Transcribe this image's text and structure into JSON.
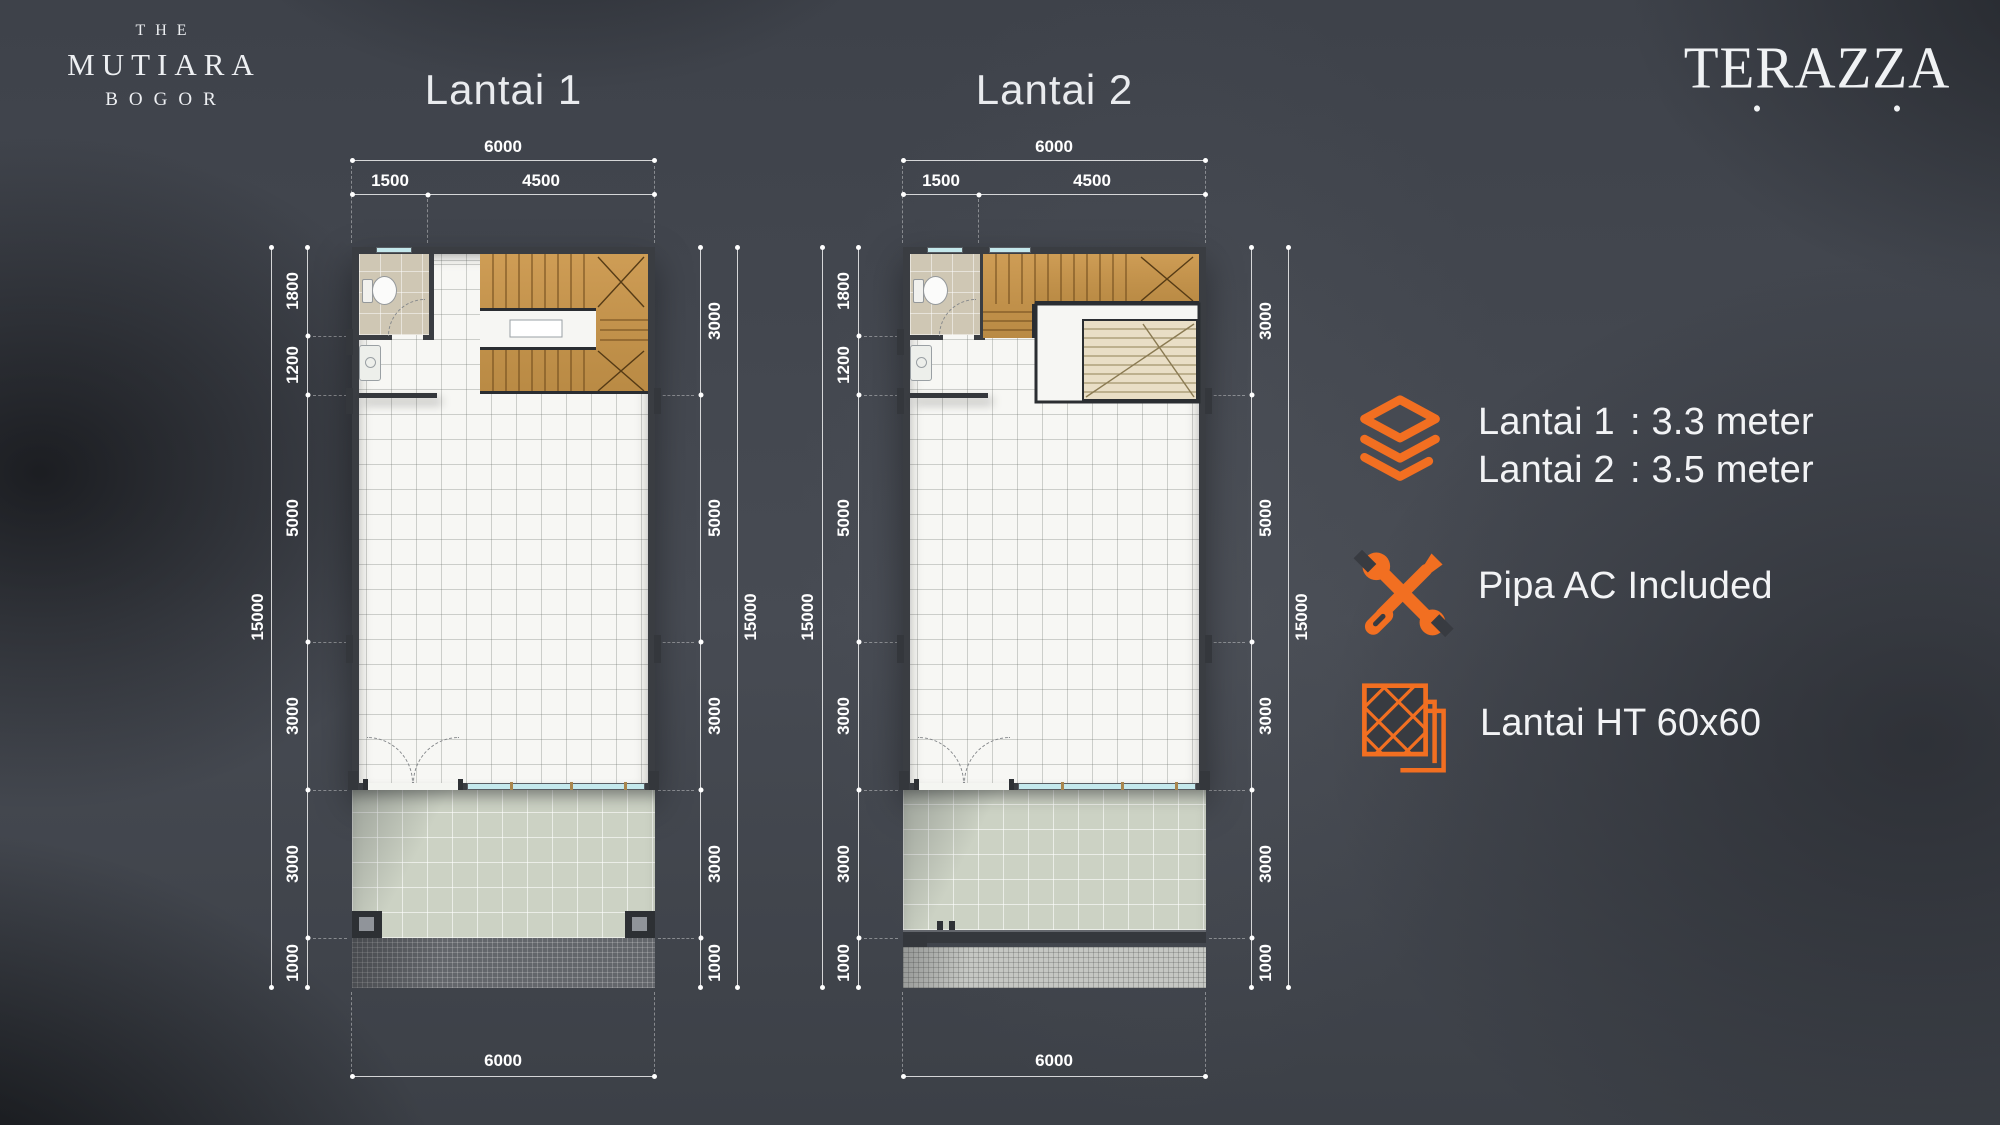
{
  "brand": {
    "line1": "THE",
    "line2": "MUTIARA",
    "line3": "BOGOR"
  },
  "product_logo": "TERAZZA",
  "colors": {
    "accent": "#F26F21",
    "wall": "#3a3d42",
    "wood": "#c5954f",
    "terrace": "#ccd2c4"
  },
  "plans": [
    {
      "title": "Lantai 1",
      "dims": {
        "top_total": "6000",
        "top_segments": [
          "1500",
          "4500"
        ],
        "left": [
          "1800",
          "1200",
          "5000",
          "3000",
          "3000",
          "1000"
        ],
        "left_total": "15000",
        "right": [
          "3000",
          "5000",
          "3000",
          "3000",
          "1000"
        ],
        "right_total": "15000",
        "bottom_total": "6000"
      }
    },
    {
      "title": "Lantai 2",
      "dims": {
        "top_total": "6000",
        "top_segments": [
          "1500",
          "4500"
        ],
        "left": [
          "1800",
          "1200",
          "5000",
          "3000",
          "3000",
          "1000"
        ],
        "left_total": "15000",
        "right": [
          "3000",
          "5000",
          "3000",
          "3000",
          "1000"
        ],
        "right_total": "15000",
        "bottom_total": "6000"
      }
    }
  ],
  "specs": {
    "heights": {
      "icon": "layers-icon",
      "rows": [
        {
          "label": "Lantai 1",
          "value": ": 3.3 meter"
        },
        {
          "label": "Lantai 2",
          "value": ": 3.5 meter"
        }
      ]
    },
    "ac": {
      "icon": "tools-icon",
      "text": "Pipa AC Included"
    },
    "floor": {
      "icon": "tile-icon",
      "text": "Lantai HT 60x60"
    }
  }
}
